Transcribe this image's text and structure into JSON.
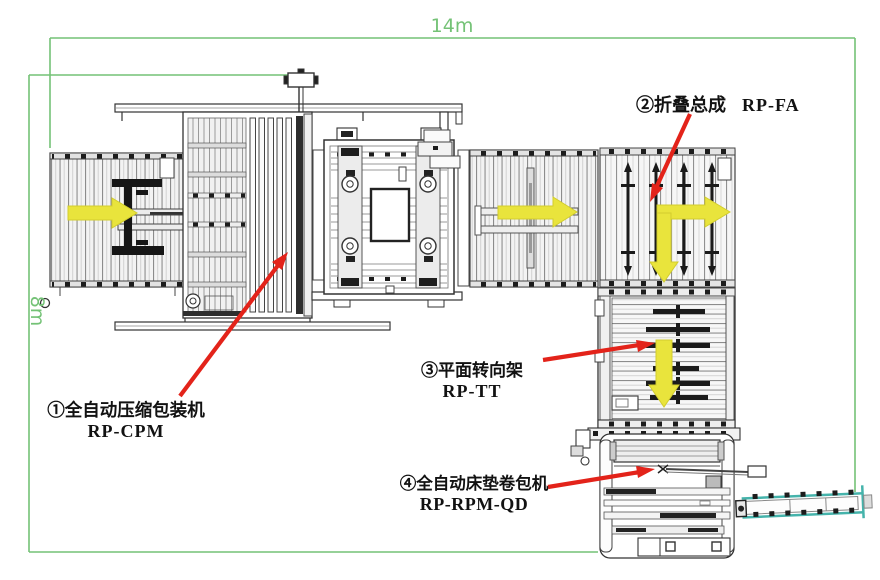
{
  "diagram": {
    "dimensions": {
      "width_label": "14m",
      "height_label": "8m"
    },
    "machines": [
      {
        "name_zh": "①全自动压缩包装机",
        "code": "RP-CPM"
      },
      {
        "name_zh": "②折叠总成",
        "code": "RP-FA"
      },
      {
        "name_zh": "③平面转向架",
        "code": "RP-TT"
      },
      {
        "name_zh": "④全自动床垫卷包机",
        "code": "RP-RPM-QD"
      }
    ],
    "colors": {
      "dimension_line": "#74c276",
      "callout_arrow": "#e3231a",
      "flow_arrow": "#e9e43c",
      "outfeed_conveyor": "#45b3ab",
      "drawing_line": "#2b2b2b"
    }
  }
}
